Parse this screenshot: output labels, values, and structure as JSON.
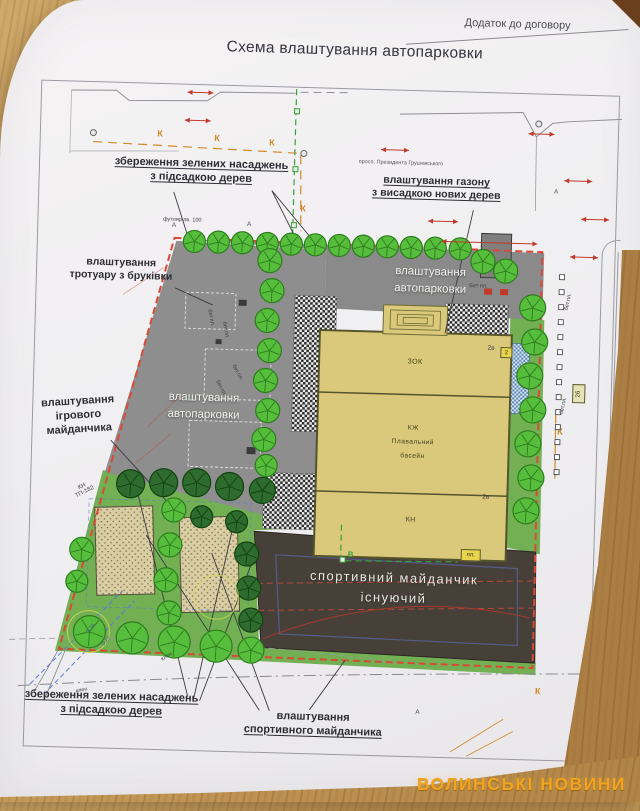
{
  "doc": {
    "appendix": "Додаток до договору",
    "title": "Схема влаштування автопарковки",
    "street": "просп. Президента Грушевського"
  },
  "callouts": {
    "preserve_top": {
      "line1": "збереження зелених насаджень",
      "line2": "з підсадкою дерев"
    },
    "lawn": {
      "line1": "влаштування газону",
      "line2": "з висадкою нових дерев"
    },
    "sidewalk": {
      "line1": "влаштування",
      "line2": "тротуару з бруківки"
    },
    "playground": {
      "line1": "влаштування",
      "line2": "ігрового",
      "line3": "майданчика"
    },
    "preserve_bottom": {
      "line1": "збереження зелених насаджень",
      "line2": "з підсадкою дерев"
    },
    "sport_new": {
      "line1": "влаштування",
      "line2": "спортивного майданчика"
    }
  },
  "areas": {
    "parking_upper": {
      "line1": "влаштування",
      "line2": "автопарковки"
    },
    "parking_left": {
      "line1": "влаштування",
      "line2": "автопарковки"
    },
    "sport_existing": {
      "line1": "спортивний майданчик",
      "line2": "існуючий"
    }
  },
  "building": {
    "s1": "ЗОК",
    "s2a": "КЖ",
    "s2b": "Плавальний",
    "s2c": "басейн",
    "s3": "КН",
    "floor_tag": "2в"
  },
  "tags": {
    "tag_2b": "2б",
    "tag_2": "2",
    "tag_pl": "пл.",
    "bet_pl": "бет.пл.",
    "bet_pl_cap": "Бет пл.",
    "kn_tp1": "КН",
    "kn_tp2": "ТП-182",
    "futlyar": "футляр пв. 100"
  },
  "markers": {
    "k": "К",
    "a": "А",
    "v": "В",
    "maple": "клен",
    "dim1": "0,34",
    "dim2": "0,27"
  },
  "watermark": "ВОЛИНСЬКІ НОВИНИ",
  "colors": {
    "paper": "#f1eff0",
    "wood": "#c89f63",
    "parking": "#8d8d8d",
    "lawn": "#72b053",
    "building": "#dbc97b",
    "sport": "#474039",
    "boundary": "#d94a35",
    "tree": "#57bd3d",
    "tree_dark": "#2e6b2e",
    "utility_k": "#d08a2a",
    "watermark": "#f3a41e"
  }
}
